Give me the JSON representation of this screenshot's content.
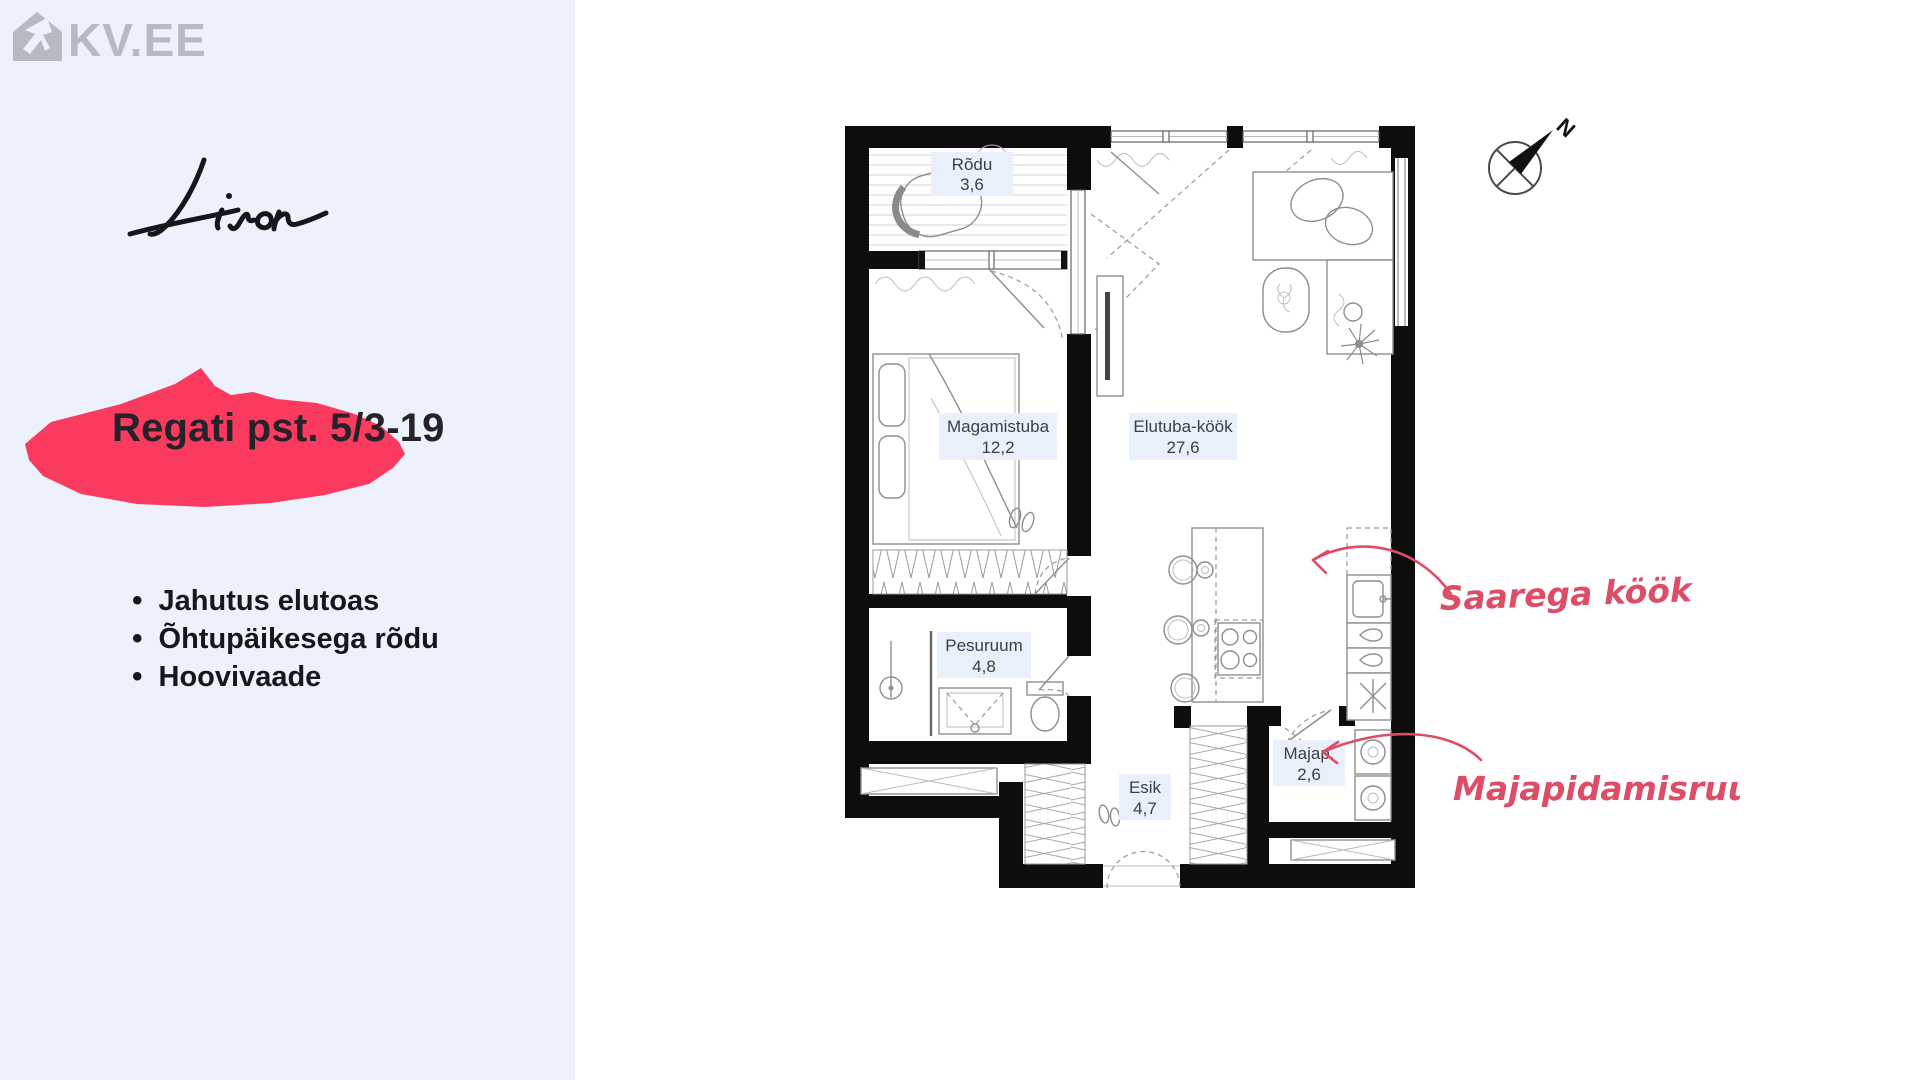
{
  "colors": {
    "sidebar_bg": "#ecf1fc",
    "accent_pink": "#fa3b5f",
    "annotation_pink": "#dd4d67",
    "logo_gray": "#b6bac3",
    "room_label_bg": "#e9effb",
    "wall_black": "#0d0d0e"
  },
  "sidebar": {
    "portal_logo": "KV.EE",
    "developer_signature": "Liven",
    "address": "Regati pst. 5/3-19",
    "features": [
      "Jahutus elutoas",
      "Õhtupäikesega rõdu",
      "Hoovivaade"
    ]
  },
  "floorplan": {
    "rooms": [
      {
        "name": "Rõdu",
        "area": "3,6"
      },
      {
        "name": "Magamistuba",
        "area": "12,2"
      },
      {
        "name": "Elutuba-köök",
        "area": "27,6"
      },
      {
        "name": "Pesuruum",
        "area": "4,8"
      },
      {
        "name": "Esik",
        "area": "4,7"
      },
      {
        "name": "Majap.",
        "area": "2,6"
      }
    ],
    "annotations": [
      {
        "text": "Saarega köök"
      },
      {
        "text": "Majapidamisruum"
      }
    ],
    "compass_label": "N"
  }
}
